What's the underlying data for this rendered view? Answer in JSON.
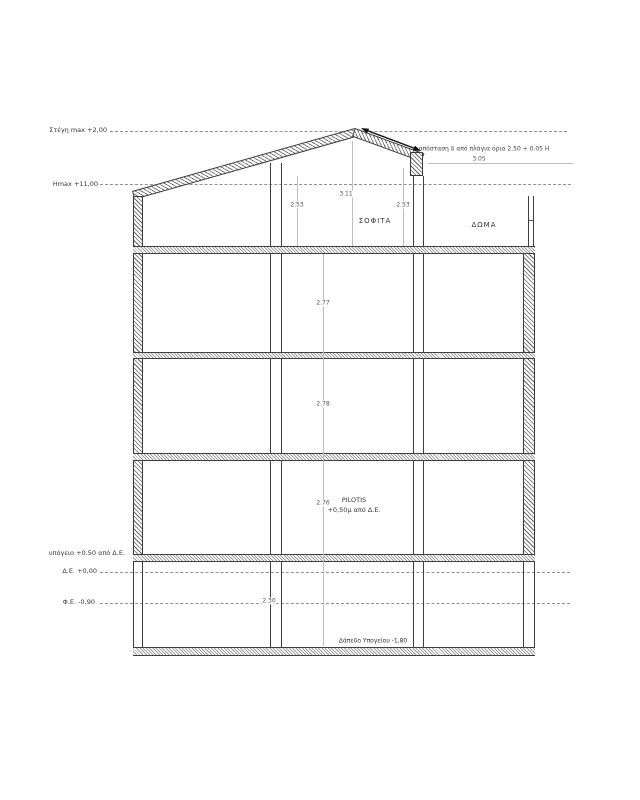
{
  "title": "Building cross-section drawing",
  "colors": {
    "background": "#ffffff",
    "outline": "#3a3a3a",
    "dim_line": "#bdbdbd",
    "text": "#333333",
    "dim_text": "#555555"
  },
  "levels": {
    "roof_max": "Στέγη max +2,00",
    "hmax": "Hmax +11,00",
    "basement_ceiling": "υπόγειο +0.50 από Δ.Ε.",
    "datum": "Δ.Ε. +0,00",
    "street": "Φ.Ε. -0,90"
  },
  "rooms": {
    "attic": "ΣΟΦΙΤΑ",
    "roof_terrace": "ΔΩΜΑ",
    "pilotis_title": "PILOTIS",
    "pilotis_sub": "+0,50μ από Δ.Ε.",
    "basement_floor": "Δάπεδο Υπογείου -1,80"
  },
  "annotations": {
    "side_setback": "απόσταση δ από πλάγια όρια 2.50 + 0.05 H",
    "side_setback_value": "3.05"
  },
  "dimensions": {
    "attic_left": "2.53",
    "attic_ridge": "3.11",
    "attic_right": "2.53",
    "floor_3": "2.77",
    "floor_2": "2.78",
    "pilotis": "2.76",
    "basement": "2.30"
  }
}
